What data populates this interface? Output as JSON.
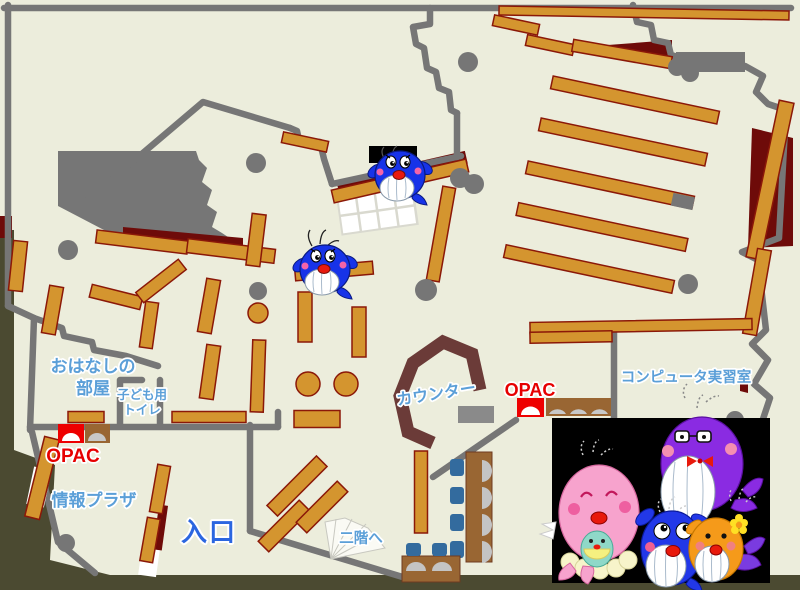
{
  "map": {
    "name": "library-first-floor-map",
    "labels": {
      "storytelling_room": [
        "おはなしの",
        "部屋"
      ],
      "kids_toilet": [
        "子ども用",
        "トイレ"
      ],
      "opac_left": "OPAC",
      "opac_right": "OPAC",
      "info_plaza": "情報プラザ",
      "entrance": "入口",
      "to_second_floor": "二階へ",
      "counter": "カウンター",
      "computer_room": "コンピュータ実習室"
    },
    "colors": {
      "floor": "#ECEDDC",
      "outside": "#4B4A31",
      "wall_gray": "#767676",
      "shelf_orange": "#D4952F",
      "shelf_border": "#8B1808",
      "maroon_area": "#6E0B09",
      "counter_brown": "#6B3B38",
      "opac_red": "#EE0000",
      "desk_brown": "#996633",
      "chair_blue": "#336B9E",
      "monitor_gray": "#C4C4C4",
      "label_blue": "#5B9FD8",
      "entrance_blue": "#2B66E0",
      "mascot_blue": "#1733E8",
      "mascot_pink": "#F7A3CD",
      "mascot_purple": "#8A2BE2",
      "mascot_orange": "#F59A1A",
      "mascot_photo_bg": "#000000"
    }
  }
}
